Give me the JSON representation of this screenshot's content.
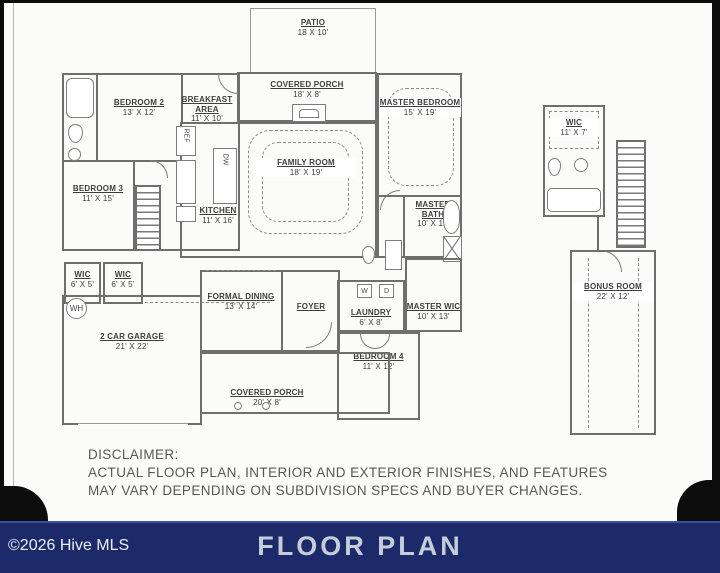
{
  "footer": {
    "copyright": "©2026 Hive MLS",
    "title": "FLOOR PLAN",
    "bg_color": "#1c2a6a",
    "title_color": "#c6cdda",
    "copyright_color": "#eceef4"
  },
  "disclaimer": {
    "heading": "DISCLAIMER:",
    "line1": "ACTUAL FLOOR PLAN, INTERIOR AND EXTERIOR FINISHES, AND FEATURES",
    "line2": "MAY VARY DEPENDING ON SUBDIVISION SPECS AND BUYER CHANGES."
  },
  "plan": {
    "rooms": {
      "patio": {
        "name": "PATIO",
        "dims": "18 X 10'"
      },
      "covered_porch_top": {
        "name": "COVERED PORCH",
        "dims": "18' X 8'"
      },
      "breakfast_area": {
        "name": "BREAKFAST AREA",
        "dims": "11' X 10'"
      },
      "bedroom2": {
        "name": "BEDROOM 2",
        "dims": "13' X 12'"
      },
      "bedroom3": {
        "name": "BEDROOM 3",
        "dims": "11' X 15'"
      },
      "family_room": {
        "name": "FAMILY ROOM",
        "dims": "18' X 19'"
      },
      "master_bedroom": {
        "name": "MASTER BEDROOM",
        "dims": "15' X 19'"
      },
      "kitchen": {
        "name": "KITCHEN",
        "dims": "11' X 16'"
      },
      "master_bath": {
        "name": "MASTER BATH",
        "dims": "10' X 11'"
      },
      "wic_a": {
        "name": "WIC",
        "dims": "6' X 5'"
      },
      "wic_b": {
        "name": "WIC",
        "dims": "6' X 5'"
      },
      "garage": {
        "name": "2 CAR GARAGE",
        "dims": "21' X 22'"
      },
      "formal_dining": {
        "name": "FORMAL DINING",
        "dims": "13' X 14'"
      },
      "foyer": {
        "name": "FOYER",
        "dims": ""
      },
      "laundry": {
        "name": "LAUNDRY",
        "dims": "6' X 8'"
      },
      "master_wic": {
        "name": "MASTER WIC",
        "dims": "10' X 13'"
      },
      "bedroom4": {
        "name": "BEDROOM 4",
        "dims": "11' X 12'"
      },
      "covered_porch_bottom": {
        "name": "COVERED PORCH",
        "dims": "20' X 8'"
      },
      "wic_upper": {
        "name": "WIC",
        "dims": "11' X 7'"
      },
      "bonus_room": {
        "name": "BONUS ROOM",
        "dims": "22' X 12'"
      }
    },
    "labels": {
      "water_heater": "WH",
      "refrigerator": "REF",
      "washer": "W",
      "dryer": "D",
      "dishwasher": "DW"
    },
    "colors": {
      "wall": "#6f6f6f",
      "label_text": "#3e3e3e"
    }
  }
}
